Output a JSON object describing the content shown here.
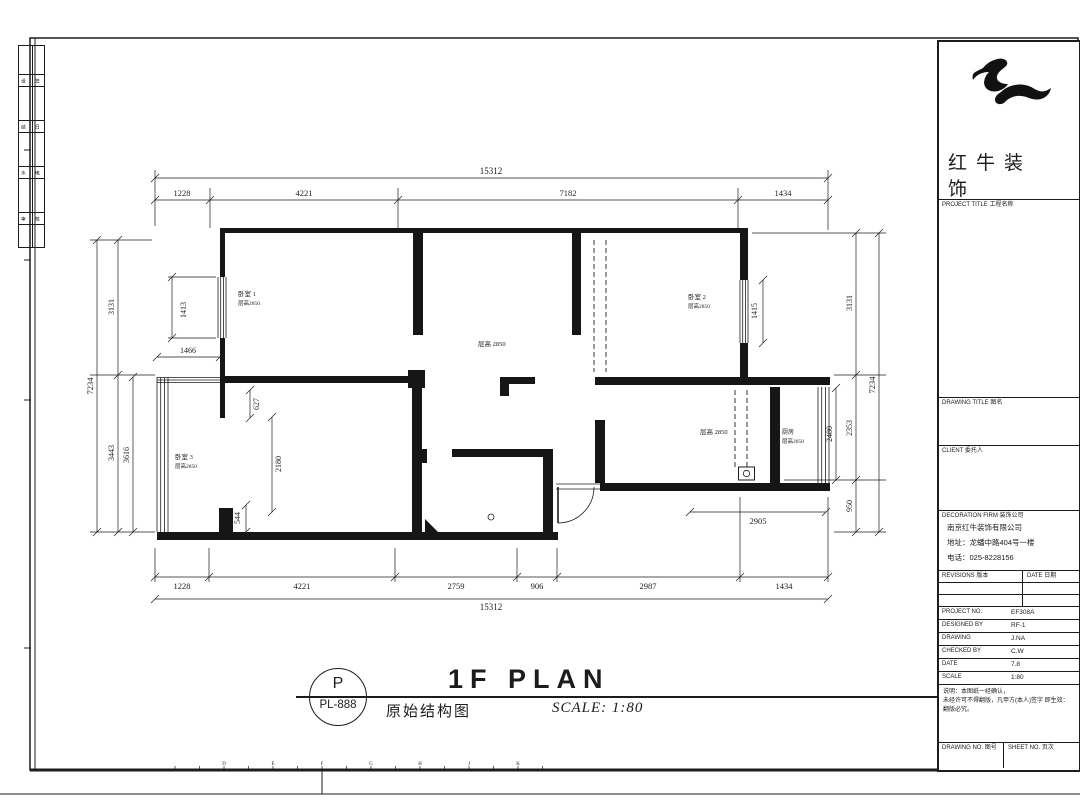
{
  "plan": {
    "dims": {
      "t_total": "15312",
      "t1": "1228",
      "t2": "4221",
      "t3": "7182",
      "t4": "1434",
      "b1": "1228",
      "b2": "4221",
      "b3": "2759",
      "b4": "906",
      "b5": "2987",
      "b6": "1434",
      "b_total": "15312",
      "l_total": "7234",
      "l1": "3131",
      "l2": "3443",
      "l3": "3616",
      "l4": "1466",
      "r1": "3131",
      "r2": "2353",
      "r3": "950",
      "r_total": "7234",
      "r4": "2480",
      "r5": "1415",
      "r6": "2905",
      "i1": "1413",
      "i2": "627",
      "i3": "2180",
      "i4": "544"
    },
    "rooms": {
      "bed1": "卧室 1",
      "bed1_sub": "层高2850",
      "bed2": "卧室 2",
      "bed2_sub": "层高2850",
      "bed3": "卧室 3",
      "bed3_sub": "层高2850",
      "living": "层高 2850",
      "dining": "层高 2850",
      "kitchen": "厨房",
      "kitchen_sub": "层高2850"
    }
  },
  "title": {
    "letter": "P",
    "code": "PL-888",
    "cn": "原始结构图",
    "en": "1F PLAN",
    "scale": "SCALE: 1:80"
  },
  "sheet": {
    "ruler": [
      "D",
      "E",
      "F",
      "G",
      "H",
      "J",
      "K"
    ]
  },
  "strip": {
    "rows": [
      [
        "设",
        "签"
      ],
      [
        "结",
        "日"
      ],
      [
        "水",
        "电"
      ],
      [
        "审",
        "核"
      ]
    ]
  },
  "titleblock": {
    "logo_line1": "红牛装",
    "logo_line2": "饰",
    "project_title_label": "PROJECT TITLE 工程名称",
    "drawing_title_label": "DRAWING TITLE 图名",
    "client_label": "CLIENT 委托人",
    "firm_label": "DECORATION FIRM 装饰公司",
    "company_name": "南京红牛装饰有限公司",
    "company_address": "地址：龙蟠中路404号一楼",
    "company_phone": "电话：025-8228156",
    "rev_label": "REVISIONS 版本",
    "rev_date_label": "DATE 日期",
    "rows": [
      {
        "label": "PROJECT NO.",
        "value": "EF308A"
      },
      {
        "label": "DESIGNED BY",
        "value": "RF-1"
      },
      {
        "label": "DRAWING",
        "value": "J.NA"
      },
      {
        "label": "CHECKED BY",
        "value": "C.W"
      },
      {
        "label": "DATE",
        "value": "7.8"
      },
      {
        "label": "SCALE",
        "value": "1:80"
      }
    ],
    "notes": [
      "说明：本图纸一经确认，",
      "未经许可不得翻版，凡甲方(本人)签字 即生效：",
      "翻版必究。"
    ],
    "drawing_no_label": "DRAWING NO. 图号",
    "sheet_no_label": "SHEET NO. 页次"
  }
}
